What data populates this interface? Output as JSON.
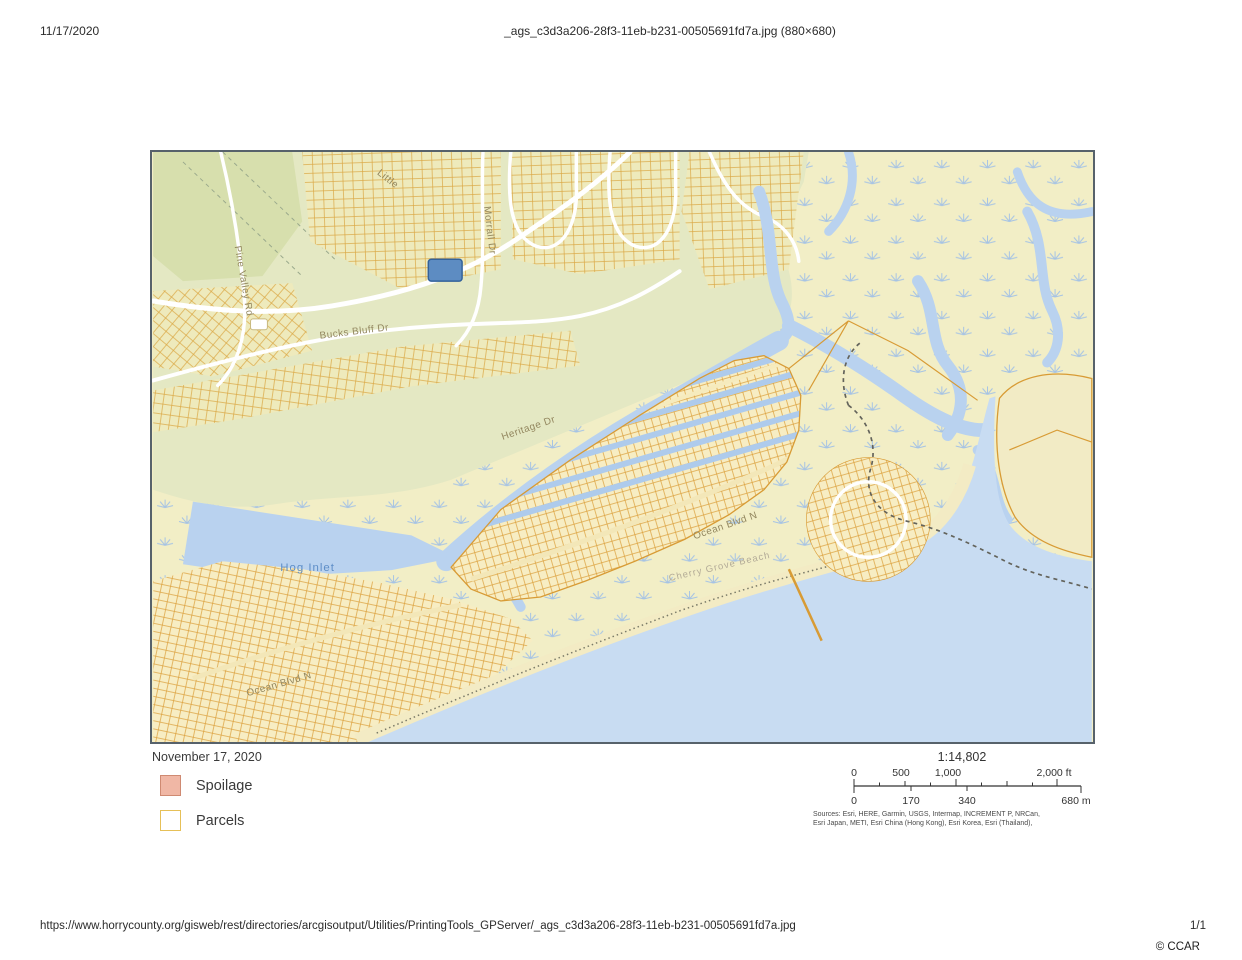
{
  "header": {
    "date": "11/17/2020",
    "title": "_ags_c3d3a206-28f3-11eb-b231-00505691fd7a.jpg (880×680)"
  },
  "footer": {
    "url": "https://www.horrycounty.org/gisweb/rest/directories/arcgisoutput/Utilities/PrintingTools_GPServer/_ags_c3d3a206-28f3-11eb-b231-00505691fd7a.jpg",
    "page": "1/1",
    "credit": "© CCAR"
  },
  "sheet": {
    "date": "November 17, 2020",
    "legend": {
      "items": [
        {
          "label": "Spoilage",
          "swatch_fill": "#f0b7a5",
          "swatch_border": "#cf8a72"
        },
        {
          "label": "Parcels",
          "swatch_fill": "#ffffff",
          "swatch_border": "#e6c058"
        }
      ]
    },
    "scalebar": {
      "ratio": "1:14,802",
      "feet": {
        "t0": "0",
        "t1": "500",
        "t2": "1,000",
        "t3": "2,000 ft"
      },
      "meters": {
        "t0": "0",
        "t1": "170",
        "t2": "340",
        "t3": "680 m"
      }
    },
    "sources": {
      "line1": "Sources: Esri, HERE, Garmin, USGS, Intermap, INCREMENT P, NRCan,",
      "line2": "Esri Japan, METI, Esri China (Hong Kong), Esri Korea, Esri (Thailand),"
    }
  },
  "map": {
    "labels": {
      "hog_inlet": "Hog Inlet",
      "bucks_bluff_dr": "Bucks Bluff Dr",
      "pine_valley_rd": "Pine Valley Rd",
      "little": "Little",
      "morrall_dr": "Morrall Dr",
      "heritage_dr": "Heritage Dr",
      "ocean_blvd_n_east": "Ocean Blvd N",
      "ocean_blvd_n_west": "Ocean Blvd N",
      "beach_name": "Cherry Grove Beach"
    },
    "colors": {
      "marsh": "#f2eec6",
      "land": "#e4e8c3",
      "water": "#b9d2ef",
      "ocean": "#c8dcf2",
      "parcel_line": "#db9f3a",
      "parcel_fill": "#f7edc3",
      "road": "#ffffff",
      "selected_parcel": "#5d8cc2",
      "boundary_dash": "#63635b"
    }
  }
}
